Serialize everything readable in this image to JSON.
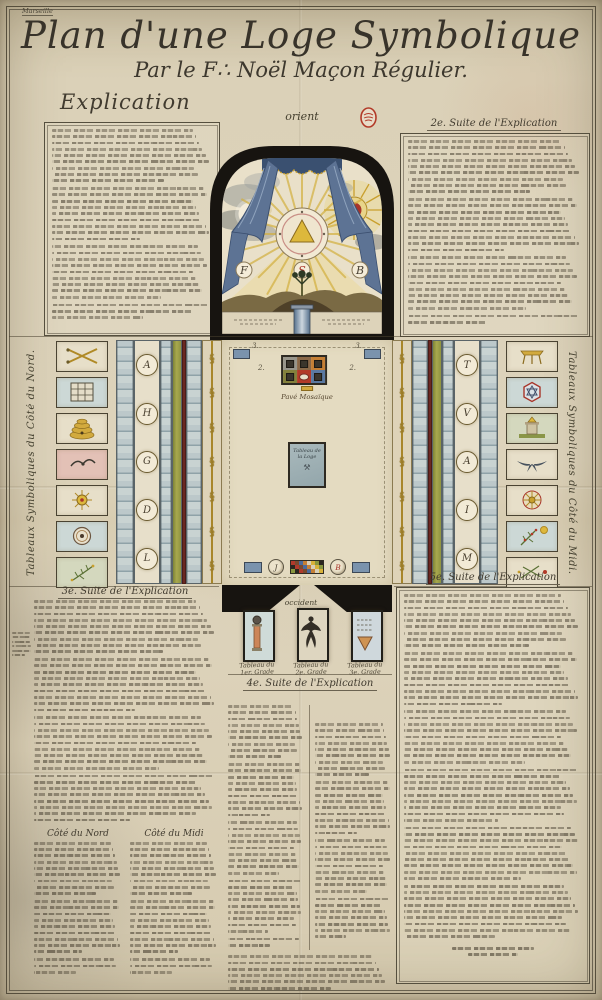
{
  "page": {
    "corner_note": "Marseille",
    "title": "Plan d'une Loge Symbolique",
    "subtitle": "Par le F∴ Noël Maçon Régulier.",
    "explication_heading": "Explication",
    "suite2_heading": "2e. Suite de l'Explication",
    "suite3_heading": "3e. Suite de l'Explication",
    "suite4_heading": "4e. Suite de l'Explication",
    "suite5_heading": "5e. Suite de l'Explication",
    "cote_nord_heading": "Côté du Nord",
    "cote_midi_heading": "Côté du Midi",
    "text_note": "Dense handwritten French manuscript text (explication of the symbolic lodge plan), largely illegible at this scale"
  },
  "plan": {
    "orient_label": "orient",
    "occident_label": "occident",
    "north_caption": "Tableaux Symboliques du Côté du Nord.",
    "south_caption": "Tableaux Symboliques du Côté du Midi.",
    "pave_label": "Pavé Mosaïque",
    "tableau_loge_line1": "Tableau de",
    "tableau_loge_line2": "la Loge",
    "letter_f": "F",
    "letter_s": "S",
    "letter_b": "B",
    "globe_left_letter": "J",
    "globe_right_letter": "B",
    "mark_top_left": "3.",
    "mark_top_right": "3.",
    "mark_pave_left": "2.",
    "mark_pave_right": "2."
  },
  "grade_panels": [
    {
      "icon": "column-with-globe-icon",
      "caption1": "Tableau du",
      "caption2": "1er. Grade"
    },
    {
      "icon": "spread-winged-figure-icon",
      "caption1": "Tableau du",
      "caption2": "2e. Grade"
    },
    {
      "icon": "inverted-triangle-icon",
      "caption1": "Tableau du",
      "caption2": "3e. Grade"
    }
  ],
  "north_symbols": [
    {
      "icon": "crossed-swords-icon"
    },
    {
      "icon": "tracing-board-grid-icon"
    },
    {
      "icon": "beehive-icon"
    },
    {
      "icon": "bird-on-pink-field-icon"
    },
    {
      "icon": "radiant-star-emblem-icon"
    },
    {
      "icon": "round-seal-icon"
    },
    {
      "icon": "sprig-of-acacia-icon"
    }
  ],
  "south_symbols": [
    {
      "icon": "altar-table-icon"
    },
    {
      "icon": "hexagram-seal-icon"
    },
    {
      "icon": "pedestal-with-triangle-icon"
    },
    {
      "icon": "swallow-icon"
    },
    {
      "icon": "compass-rosette-icon"
    },
    {
      "icon": "flowering-branch-icon"
    },
    {
      "icon": "sprig-with-red-blossoms-icon"
    }
  ],
  "medallions": {
    "north_letters": [
      "A",
      "H",
      "G",
      "D",
      "L"
    ],
    "south_letters": [
      "T",
      "V",
      "A",
      "I",
      "M"
    ]
  },
  "pave": {
    "cells": [
      "#98958b",
      "#8a6848",
      "#c57f35",
      "#83803c",
      "#b23a28",
      "#5b79a1"
    ]
  },
  "mosaic_palette": [
    "#b03a2c",
    "#d8b23a",
    "#4a6a9c",
    "#2a2620",
    "#d8cfb8",
    "#7a4a2e",
    "#88963f",
    "#c57f35"
  ],
  "decor": {
    "cord_knot_glyph": "§",
    "stamp_icon": "red-oval-collection-stamp-icon"
  },
  "colors": {
    "paper": "#d9cfb6",
    "ink": "#3f3a2e",
    "arch_black": "#171410",
    "curtain_blue": "#5d7394",
    "gold": "#c9a02e",
    "sun_red": "#a8352a",
    "band_blue_grey": "#bcc8ca",
    "band_green": "#8f9340",
    "floor": "#e4dbc1"
  }
}
